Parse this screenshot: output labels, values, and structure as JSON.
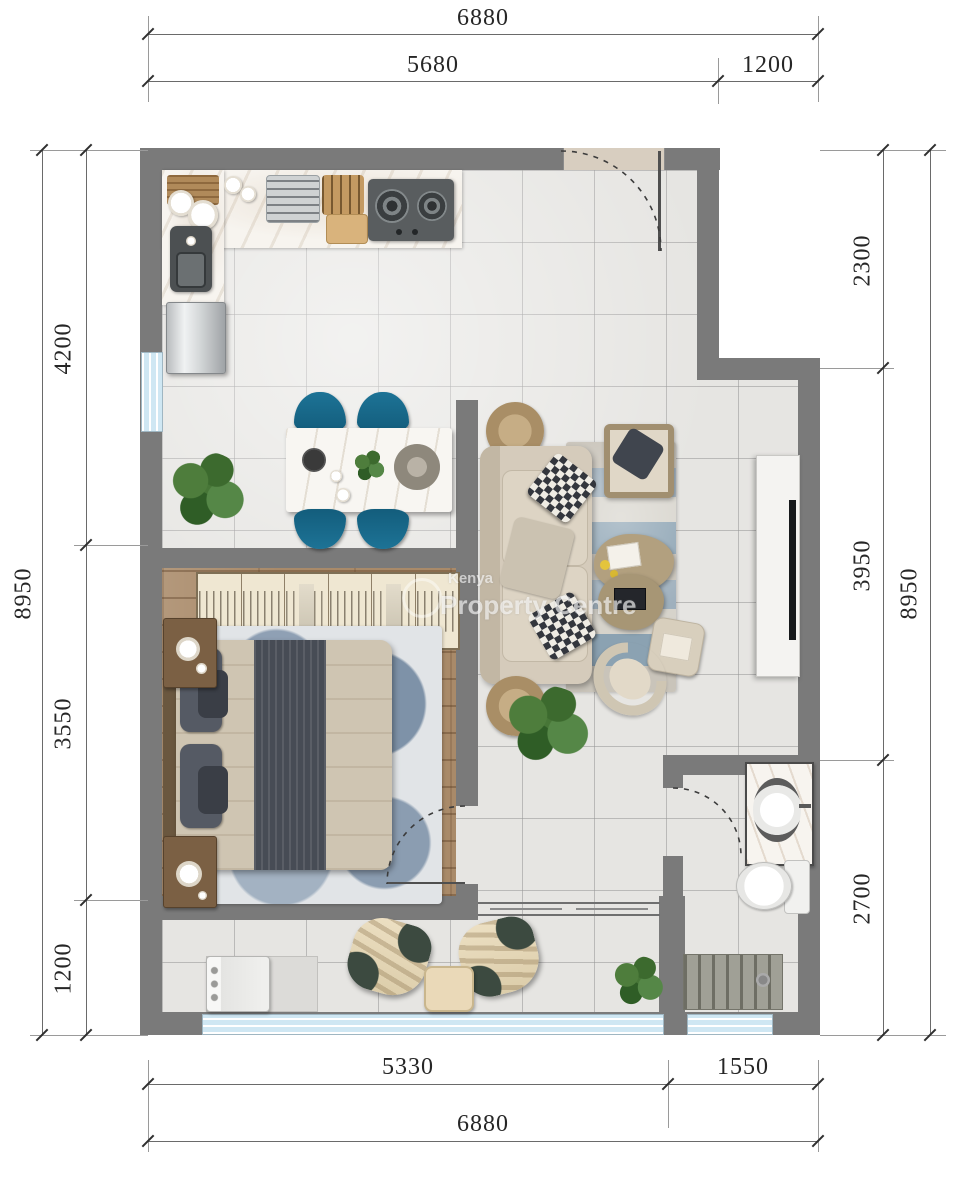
{
  "watermark": {
    "brand_small": "Kenya",
    "brand_large": "Property Centre"
  },
  "dimensions": {
    "top": {
      "overall": "6880",
      "segments": [
        "5680",
        "1200"
      ]
    },
    "bottom": {
      "overall": "6880",
      "segments": [
        "5330",
        "1550"
      ]
    },
    "left": {
      "overall": "8950",
      "segments": [
        "4200",
        "3550",
        "1200"
      ]
    },
    "right": {
      "overall": "8950",
      "segments": [
        "2300",
        "3950",
        "2700"
      ]
    }
  },
  "colors": {
    "wall": "#7a7a7a",
    "floor_tile": "#e6e5e2",
    "wood_floor": "#a98a69",
    "window": "#cfe7f3",
    "dining_chair": "#176687",
    "sofa_beige": "#d5cbbb",
    "dimension_text": "#262626"
  }
}
